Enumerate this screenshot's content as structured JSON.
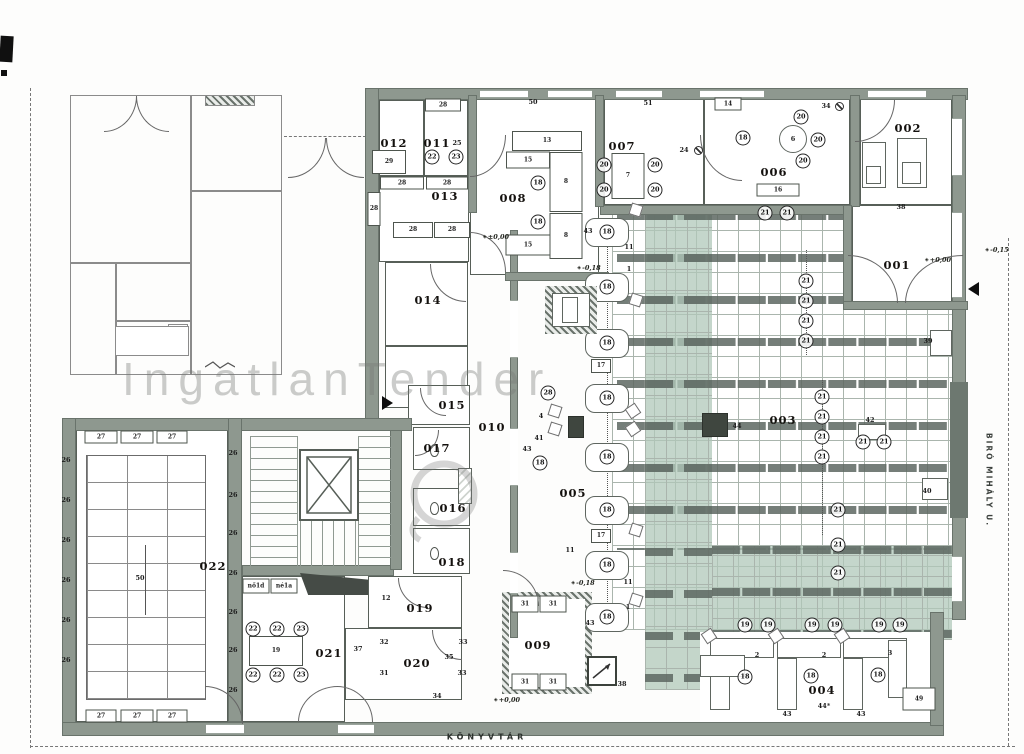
{
  "colors": {
    "wall": "#8e988f",
    "walledge": "#69736b",
    "gridln": "#aab5ad",
    "green": "#bed2c6",
    "shelf": "#5d6761"
  },
  "watermark": {
    "text": "IngatlanTender"
  },
  "street": {
    "label": "BIRÓ MIHÁLY U."
  },
  "footer": {
    "label": "KÖNYVTÁR"
  },
  "rooms": [
    {
      "label": "001",
      "x": 897,
      "y": 265
    },
    {
      "label": "002",
      "x": 908,
      "y": 128
    },
    {
      "label": "003",
      "x": 783,
      "y": 420
    },
    {
      "label": "004",
      "x": 822,
      "y": 690
    },
    {
      "label": "005",
      "x": 573,
      "y": 493
    },
    {
      "label": "006",
      "x": 774,
      "y": 172
    },
    {
      "label": "007",
      "x": 622,
      "y": 146
    },
    {
      "label": "008",
      "x": 513,
      "y": 198
    },
    {
      "label": "009",
      "x": 538,
      "y": 645
    },
    {
      "label": "010",
      "x": 492,
      "y": 427
    },
    {
      "label": "011",
      "x": 437,
      "y": 143
    },
    {
      "label": "012",
      "x": 394,
      "y": 143
    },
    {
      "label": "013",
      "x": 445,
      "y": 196
    },
    {
      "label": "014",
      "x": 428,
      "y": 300
    },
    {
      "label": "015",
      "x": 452,
      "y": 405
    },
    {
      "label": "016",
      "x": 453,
      "y": 508
    },
    {
      "label": "017",
      "x": 437,
      "y": 448
    },
    {
      "label": "018",
      "x": 452,
      "y": 562
    },
    {
      "label": "019",
      "x": 420,
      "y": 608
    },
    {
      "label": "020",
      "x": 417,
      "y": 663
    },
    {
      "label": "021",
      "x": 329,
      "y": 653
    },
    {
      "label": "022",
      "x": 213,
      "y": 566
    }
  ],
  "markers": [
    {
      "n": "18",
      "x": 538,
      "y": 183
    },
    {
      "n": "18",
      "x": 538,
      "y": 222
    },
    {
      "n": "22",
      "x": 432,
      "y": 157
    },
    {
      "n": "23",
      "x": 456,
      "y": 157
    },
    {
      "n": "20",
      "x": 604,
      "y": 165
    },
    {
      "n": "20",
      "x": 655,
      "y": 165
    },
    {
      "n": "20",
      "x": 604,
      "y": 190
    },
    {
      "n": "20",
      "x": 655,
      "y": 190
    },
    {
      "n": "18",
      "x": 743,
      "y": 138
    },
    {
      "n": "20",
      "x": 801,
      "y": 117
    },
    {
      "n": "20",
      "x": 818,
      "y": 140
    },
    {
      "n": "20",
      "x": 803,
      "y": 161
    },
    {
      "n": "21",
      "x": 765,
      "y": 213
    },
    {
      "n": "21",
      "x": 787,
      "y": 213
    },
    {
      "n": "21",
      "x": 806,
      "y": 281
    },
    {
      "n": "21",
      "x": 806,
      "y": 301
    },
    {
      "n": "21",
      "x": 806,
      "y": 321
    },
    {
      "n": "21",
      "x": 806,
      "y": 341
    },
    {
      "n": "21",
      "x": 822,
      "y": 397
    },
    {
      "n": "21",
      "x": 822,
      "y": 417
    },
    {
      "n": "21",
      "x": 822,
      "y": 437
    },
    {
      "n": "21",
      "x": 822,
      "y": 457
    },
    {
      "n": "21",
      "x": 863,
      "y": 442
    },
    {
      "n": "21",
      "x": 884,
      "y": 442
    },
    {
      "n": "21",
      "x": 838,
      "y": 510
    },
    {
      "n": "21",
      "x": 838,
      "y": 545
    },
    {
      "n": "21",
      "x": 838,
      "y": 573
    },
    {
      "n": "18",
      "x": 607,
      "y": 232
    },
    {
      "n": "18",
      "x": 607,
      "y": 287
    },
    {
      "n": "18",
      "x": 607,
      "y": 343
    },
    {
      "n": "18",
      "x": 607,
      "y": 398
    },
    {
      "n": "18",
      "x": 607,
      "y": 457
    },
    {
      "n": "18",
      "x": 607,
      "y": 510
    },
    {
      "n": "18",
      "x": 607,
      "y": 565
    },
    {
      "n": "18",
      "x": 607,
      "y": 617
    },
    {
      "n": "28",
      "x": 548,
      "y": 393
    },
    {
      "n": "18",
      "x": 540,
      "y": 463
    },
    {
      "n": "18",
      "x": 745,
      "y": 677
    },
    {
      "n": "18",
      "x": 811,
      "y": 676
    },
    {
      "n": "18",
      "x": 878,
      "y": 675
    },
    {
      "n": "19",
      "x": 745,
      "y": 625
    },
    {
      "n": "19",
      "x": 768,
      "y": 625
    },
    {
      "n": "19",
      "x": 812,
      "y": 625
    },
    {
      "n": "19",
      "x": 835,
      "y": 625
    },
    {
      "n": "19",
      "x": 879,
      "y": 625
    },
    {
      "n": "19",
      "x": 900,
      "y": 625
    },
    {
      "n": "22",
      "x": 253,
      "y": 629
    },
    {
      "n": "22",
      "x": 277,
      "y": 629
    },
    {
      "n": "23",
      "x": 301,
      "y": 629
    },
    {
      "n": "22",
      "x": 253,
      "y": 675
    },
    {
      "n": "22",
      "x": 277,
      "y": 675
    },
    {
      "n": "23",
      "x": 301,
      "y": 675
    }
  ],
  "labels": [
    {
      "t": "28",
      "x": 443,
      "y": 105,
      "cls": "cell",
      "w": 36,
      "h": 13
    },
    {
      "t": "29",
      "x": 389,
      "y": 162,
      "cls": "cell",
      "w": 34,
      "h": 24
    },
    {
      "t": "28",
      "x": 402,
      "y": 183,
      "cls": "cell",
      "w": 44,
      "h": 13
    },
    {
      "t": "28",
      "x": 447,
      "y": 183,
      "cls": "cell",
      "w": 42,
      "h": 13
    },
    {
      "t": "28",
      "x": 413,
      "y": 230,
      "cls": "cell",
      "w": 40,
      "h": 16
    },
    {
      "t": "28",
      "x": 452,
      "y": 230,
      "cls": "cell",
      "w": 36,
      "h": 16
    },
    {
      "t": "28",
      "x": 374,
      "y": 209,
      "cls": "cell",
      "w": 13,
      "h": 34
    },
    {
      "t": "13",
      "x": 547,
      "y": 141,
      "cls": "cell",
      "w": 70,
      "h": 20
    },
    {
      "t": "15",
      "x": 528,
      "y": 160,
      "cls": "cell",
      "w": 44,
      "h": 17
    },
    {
      "t": "8",
      "x": 566,
      "y": 182,
      "cls": "cell",
      "w": 33,
      "h": 60
    },
    {
      "t": "8",
      "x": 566,
      "y": 236,
      "cls": "cell",
      "w": 33,
      "h": 46
    },
    {
      "t": "15",
      "x": 528,
      "y": 245,
      "cls": "cell",
      "w": 45,
      "h": 21
    },
    {
      "t": "7",
      "x": 628,
      "y": 176,
      "cls": "cell",
      "w": 33,
      "h": 46
    },
    {
      "t": "14",
      "x": 728,
      "y": 104,
      "cls": "cell",
      "w": 27,
      "h": 13
    },
    {
      "t": "16",
      "x": 778,
      "y": 190,
      "cls": "cell",
      "w": 43,
      "h": 13
    },
    {
      "t": "19",
      "x": 276,
      "y": 651,
      "cls": "cell",
      "w": 54,
      "h": 30
    },
    {
      "t": "31",
      "x": 525,
      "y": 604,
      "cls": "cell",
      "w": 27,
      "h": 17
    },
    {
      "t": "31",
      "x": 553,
      "y": 604,
      "cls": "cell",
      "w": 27,
      "h": 17
    },
    {
      "t": "31",
      "x": 525,
      "y": 682,
      "cls": "cell",
      "w": 27,
      "h": 17
    },
    {
      "t": "31",
      "x": 553,
      "y": 682,
      "cls": "cell",
      "w": 27,
      "h": 17
    },
    {
      "t": "49",
      "x": 919,
      "y": 699,
      "cls": "cell",
      "w": 33,
      "h": 23
    },
    {
      "t": "17",
      "x": 601,
      "y": 366,
      "cls": "cell",
      "w": 20,
      "h": 14
    },
    {
      "t": "17",
      "x": 601,
      "y": 536,
      "cls": "cell",
      "w": 20,
      "h": 14
    },
    {
      "t": "27",
      "x": 101,
      "y": 437,
      "cls": "cell",
      "w": 33,
      "h": 13
    },
    {
      "t": "27",
      "x": 137,
      "y": 437,
      "cls": "cell",
      "w": 33,
      "h": 13
    },
    {
      "t": "27",
      "x": 172,
      "y": 437,
      "cls": "cell",
      "w": 31,
      "h": 13
    },
    {
      "t": "27",
      "x": 101,
      "y": 716,
      "cls": "cell",
      "w": 31,
      "h": 13
    },
    {
      "t": "27",
      "x": 137,
      "y": 716,
      "cls": "cell",
      "w": 33,
      "h": 13
    },
    {
      "t": "27",
      "x": 172,
      "y": 716,
      "cls": "cell",
      "w": 31,
      "h": 13
    },
    {
      "t": "nő1d",
      "x": 256,
      "y": 586,
      "cls": "cell",
      "w": 27,
      "h": 15
    },
    {
      "t": "né1a",
      "x": 284,
      "y": 586,
      "cls": "cell",
      "w": 27,
      "h": 15
    },
    {
      "t": "50",
      "x": 533,
      "y": 102
    },
    {
      "t": "51",
      "x": 648,
      "y": 103
    },
    {
      "t": "24",
      "x": 684,
      "y": 150
    },
    {
      "t": "34",
      "x": 826,
      "y": 106
    },
    {
      "t": "25",
      "x": 457,
      "y": 143
    },
    {
      "t": "6",
      "x": 793,
      "y": 139
    },
    {
      "t": "38",
      "x": 901,
      "y": 207
    },
    {
      "t": "39",
      "x": 928,
      "y": 341
    },
    {
      "t": "40",
      "x": 927,
      "y": 491
    },
    {
      "t": "42",
      "x": 870,
      "y": 420
    },
    {
      "t": "44",
      "x": 737,
      "y": 426
    },
    {
      "t": "43",
      "x": 588,
      "y": 231
    },
    {
      "t": "11",
      "x": 629,
      "y": 247
    },
    {
      "t": "1",
      "x": 629,
      "y": 269
    },
    {
      "t": "4",
      "x": 541,
      "y": 416
    },
    {
      "t": "41",
      "x": 539,
      "y": 438
    },
    {
      "t": "43",
      "x": 527,
      "y": 449
    },
    {
      "t": "11",
      "x": 570,
      "y": 550
    },
    {
      "t": "11",
      "x": 628,
      "y": 582
    },
    {
      "t": "1",
      "x": 628,
      "y": 607
    },
    {
      "t": "43",
      "x": 590,
      "y": 623
    },
    {
      "t": "38",
      "x": 622,
      "y": 684
    },
    {
      "t": "12",
      "x": 386,
      "y": 598
    },
    {
      "t": "32",
      "x": 384,
      "y": 642
    },
    {
      "t": "33",
      "x": 463,
      "y": 642
    },
    {
      "t": "35",
      "x": 449,
      "y": 657
    },
    {
      "t": "33",
      "x": 462,
      "y": 673
    },
    {
      "t": "34",
      "x": 437,
      "y": 696
    },
    {
      "t": "37",
      "x": 358,
      "y": 649
    },
    {
      "t": "31",
      "x": 384,
      "y": 673
    },
    {
      "t": "26",
      "x": 233,
      "y": 453
    },
    {
      "t": "26",
      "x": 233,
      "y": 495
    },
    {
      "t": "26",
      "x": 233,
      "y": 533
    },
    {
      "t": "26",
      "x": 233,
      "y": 573
    },
    {
      "t": "26",
      "x": 233,
      "y": 612
    },
    {
      "t": "26",
      "x": 233,
      "y": 650
    },
    {
      "t": "26",
      "x": 233,
      "y": 690
    },
    {
      "t": "26",
      "x": 66,
      "y": 460
    },
    {
      "t": "26",
      "x": 66,
      "y": 500
    },
    {
      "t": "26",
      "x": 66,
      "y": 540
    },
    {
      "t": "26",
      "x": 66,
      "y": 580
    },
    {
      "t": "26",
      "x": 66,
      "y": 620
    },
    {
      "t": "26",
      "x": 66,
      "y": 660
    },
    {
      "t": "50",
      "x": 140,
      "y": 578
    },
    {
      "t": "2",
      "x": 757,
      "y": 655
    },
    {
      "t": "2",
      "x": 824,
      "y": 655
    },
    {
      "t": "3",
      "x": 890,
      "y": 653
    },
    {
      "t": "43",
      "x": 787,
      "y": 714
    },
    {
      "t": "44*",
      "x": 824,
      "y": 706
    },
    {
      "t": "43",
      "x": 861,
      "y": 714
    }
  ],
  "elevations": [
    {
      "t": "±0,00",
      "x": 496,
      "y": 237
    },
    {
      "t": "-0,18",
      "x": 589,
      "y": 268
    },
    {
      "t": "-0,18",
      "x": 583,
      "y": 583
    },
    {
      "t": "+0,00",
      "x": 507,
      "y": 700
    },
    {
      "t": "+0,00",
      "x": 938,
      "y": 260
    },
    {
      "t": "-0,15",
      "x": 997,
      "y": 250
    }
  ]
}
